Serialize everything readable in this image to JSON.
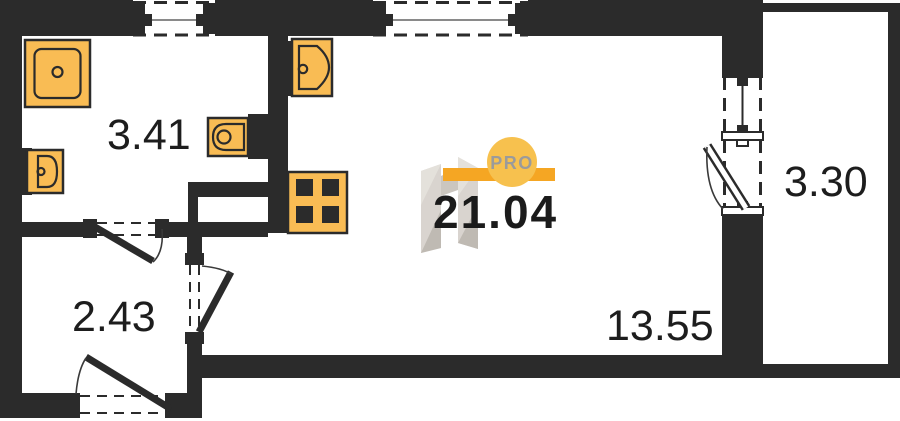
{
  "document_type": "apartment-floor-plan",
  "total": {
    "area": "21.04"
  },
  "rooms": {
    "bathroom": {
      "area": "3.41"
    },
    "hallway": {
      "area": "2.43"
    },
    "living_kitchen": {
      "area": "13.55"
    },
    "balcony": {
      "area": "3.30"
    }
  },
  "watermark": {
    "badge": "PRO"
  },
  "icons": [
    "washing-machine-icon",
    "wash-basin-icon",
    "toilet-icon",
    "kitchen-sink-icon",
    "stove-icon",
    "window-icon",
    "door-swing-icon"
  ],
  "colors": {
    "wall": "#2b2b2b",
    "fixture_fill": "#f9bc54",
    "fixture_outline": "#2b2b2b",
    "glass_line": "#8a8a8a",
    "watermark_bar": "#f5a623",
    "watermark_circle": "#f7c14e",
    "watermark_text": "#9b9b9b",
    "watermark_logo_grey": "#d5d0ca",
    "label_text": "#1d1d1d",
    "background": "#ffffff"
  }
}
